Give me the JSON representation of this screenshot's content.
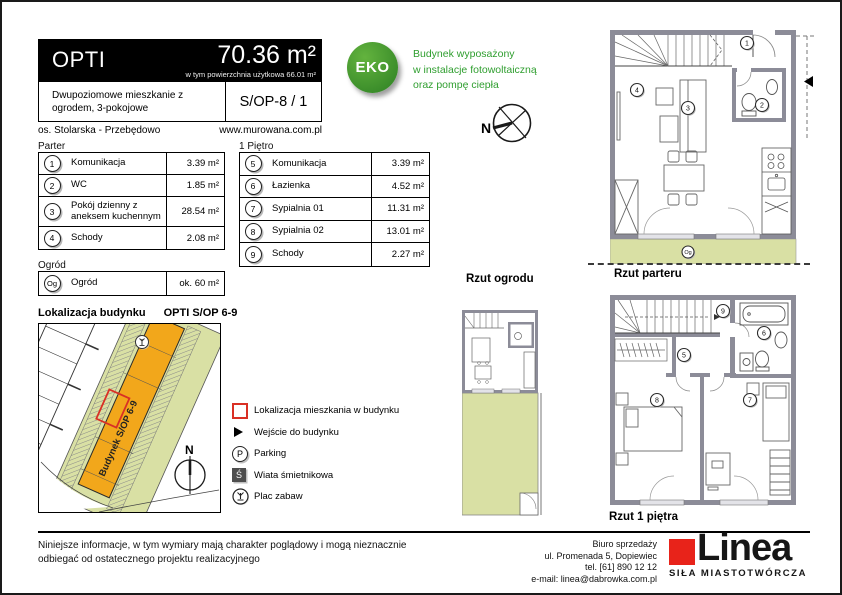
{
  "header": {
    "name": "OPTI",
    "area": "70.36 m²",
    "area_note": "w tym powierzchnia użytkowa 66.01 m²",
    "description": "Dwupoziomowe mieszkanie z ogrodem, 3-pokojowe",
    "unit_code": "S/OP-8 / 1",
    "location": "os. Stolarska - Przebędowo",
    "website": "www.murowana.com.pl"
  },
  "eco": {
    "badge": "EKO",
    "line1": "Budynek wyposażony",
    "line2": "w instalacje fotowoltaiczną",
    "line3": "oraz pompę ciepła"
  },
  "compass": {
    "label": "N"
  },
  "tables": {
    "parter": {
      "title": "Parter",
      "rows": [
        {
          "no": "1",
          "name": "Komunikacja",
          "area": "3.39 m²"
        },
        {
          "no": "2",
          "name": "WC",
          "area": "1.85 m²"
        },
        {
          "no": "3",
          "name": "Pokój dzienny z aneksem kuchennym",
          "area": "28.54 m²"
        },
        {
          "no": "4",
          "name": "Schody",
          "area": "2.08 m²"
        }
      ]
    },
    "pietro": {
      "title": "1 Piętro",
      "rows": [
        {
          "no": "5",
          "name": "Komunikacja",
          "area": "3.39 m²"
        },
        {
          "no": "6",
          "name": "Łazienka",
          "area": "4.52 m²"
        },
        {
          "no": "7",
          "name": "Sypialnia 01",
          "area": "11.31 m²"
        },
        {
          "no": "8",
          "name": "Sypialnia 02",
          "area": "13.01 m²"
        },
        {
          "no": "9",
          "name": "Schody",
          "area": "2.27 m²"
        }
      ]
    },
    "ogrod": {
      "title": "Ogród",
      "rows": [
        {
          "no": "Og",
          "name": "Ogród",
          "area": "ok. 60 m²"
        }
      ]
    }
  },
  "site": {
    "title": "Lokalizacja budynku",
    "subtitle": "OPTI S/OP 6-9",
    "building_label": "Budynek S/OP 6-9"
  },
  "legend": {
    "items": [
      {
        "label": "Lokalizacja mieszkania w budynku"
      },
      {
        "label": "Wejście do budynku"
      },
      {
        "symbol": "P",
        "label": "Parking"
      },
      {
        "symbol": "Ś",
        "label": "Wiata śmietnikowa"
      },
      {
        "label": "Plac zabaw"
      }
    ]
  },
  "plans": {
    "garden": {
      "title": "Rzut ogrodu"
    },
    "ground": {
      "title": "Rzut parteru",
      "markers": {
        "m1": "1",
        "m2": "2",
        "m3": "3",
        "m4": "4",
        "og": "Og"
      }
    },
    "first": {
      "title": "Rzut 1 piętra",
      "markers": {
        "m5": "5",
        "m6": "6",
        "m7": "7",
        "m8": "8",
        "m9": "9"
      }
    }
  },
  "footer": {
    "disclaimer1": "Niniejsze informacje, w tym wymiary mają charakter poglądowy i mogą nieznacznie",
    "disclaimer2": "odbiegać od ostatecznego projektu realizacyjnego",
    "contact": {
      "line1": "Biuro sprzedaży",
      "line2": "ul. Promenada 5, Dopiewiec",
      "line3": "tel. [61] 890 12 12",
      "line4": "e-mail: linea@dabrowka.com.pl"
    },
    "logo": {
      "name": "Linea",
      "tagline": "SIŁA MIASTOTWÓRCZA"
    }
  },
  "colors": {
    "eco_green": "#2f9e2f",
    "garden_green": "#d9e0a4",
    "wall_gray": "#8c8c98",
    "building_orange": "#f2a71b",
    "marker_red": "#d93025",
    "logo_red": "#e8231a"
  }
}
